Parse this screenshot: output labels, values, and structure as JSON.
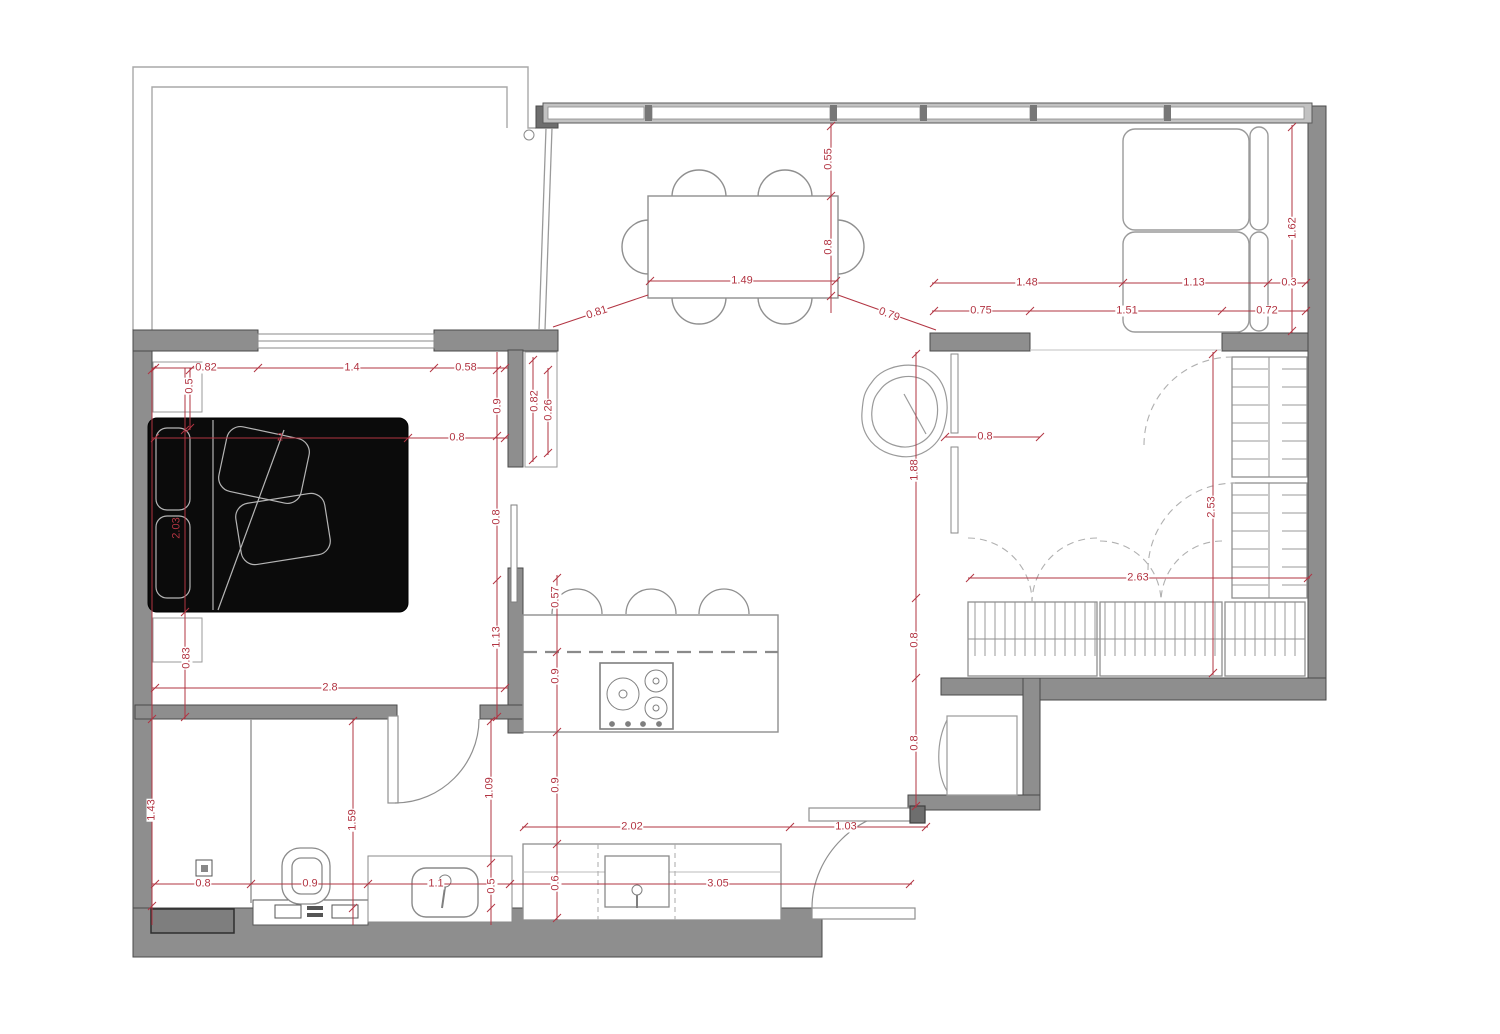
{
  "floorplan": {
    "colors": {
      "dimension_red": "#b23442",
      "wall_gray": "#8e8e8e",
      "wall_dark": "#6e6e6e",
      "bed_black": "#0b0b0b",
      "thin_line_gray": "#9a9a9a"
    },
    "elements": [
      "terrace",
      "living-dining-area",
      "dining-table",
      "dining-chairs",
      "sofa",
      "bedroom",
      "bed",
      "pillows",
      "headboard-cushions",
      "nightstands",
      "wardrobe-cabinet",
      "kitchen-island",
      "cooktop",
      "bar-stools",
      "kitchen-counter",
      "counter-sink",
      "bathroom",
      "shower",
      "shower-drain",
      "toilet",
      "cistern",
      "bathroom-sink",
      "walk-in-closet",
      "shelving-units",
      "hanging-wardrobe",
      "plant",
      "entry-door",
      "bathroom-door",
      "appliance-niche"
    ],
    "dimension_labels": [
      {
        "text": "0.55",
        "x": 829,
        "y": 159,
        "rotate": -90
      },
      {
        "text": "0.8",
        "x": 829,
        "y": 247,
        "rotate": -90
      },
      {
        "text": "1.49",
        "x": 742,
        "y": 281,
        "rotate": 0
      },
      {
        "text": "0.81",
        "x": 597,
        "y": 313,
        "rotate": -18
      },
      {
        "text": "0.79",
        "x": 889,
        "y": 315,
        "rotate": 20
      },
      {
        "text": "1.48",
        "x": 1027,
        "y": 283,
        "rotate": 0
      },
      {
        "text": "1.13",
        "x": 1194,
        "y": 283,
        "rotate": 0
      },
      {
        "text": "0.3",
        "x": 1289,
        "y": 283,
        "rotate": 0
      },
      {
        "text": "0.75",
        "x": 981,
        "y": 311,
        "rotate": 0
      },
      {
        "text": "1.51",
        "x": 1127,
        "y": 311,
        "rotate": 0
      },
      {
        "text": "0.72",
        "x": 1267,
        "y": 311,
        "rotate": 0
      },
      {
        "text": "1.62",
        "x": 1293,
        "y": 228,
        "rotate": -90
      },
      {
        "text": "0.82",
        "x": 206,
        "y": 368,
        "rotate": 0
      },
      {
        "text": "1.4",
        "x": 352,
        "y": 368,
        "rotate": 0
      },
      {
        "text": "0.58",
        "x": 466,
        "y": 368,
        "rotate": 0
      },
      {
        "text": "0.5",
        "x": 190,
        "y": 386,
        "rotate": -90
      },
      {
        "text": "0.9",
        "x": 498,
        "y": 406,
        "rotate": -90
      },
      {
        "text": "2",
        "x": 280,
        "y": 438,
        "rotate": 0,
        "bg": false
      },
      {
        "text": "0.8",
        "x": 457,
        "y": 438,
        "rotate": 0
      },
      {
        "text": "0.82",
        "x": 535,
        "y": 401,
        "rotate": -90
      },
      {
        "text": "0.26",
        "x": 549,
        "y": 410,
        "rotate": -90
      },
      {
        "text": "0.8",
        "x": 497,
        "y": 517,
        "rotate": -90
      },
      {
        "text": "1.13",
        "x": 497,
        "y": 637,
        "rotate": -90
      },
      {
        "text": "2.03",
        "x": 177,
        "y": 528,
        "rotate": -90,
        "bg": false
      },
      {
        "text": "0.83",
        "x": 187,
        "y": 658,
        "rotate": -90
      },
      {
        "text": "2.8",
        "x": 330,
        "y": 688,
        "rotate": 0
      },
      {
        "text": "0.8",
        "x": 985,
        "y": 437,
        "rotate": 0
      },
      {
        "text": "1.88",
        "x": 915,
        "y": 470,
        "rotate": -90
      },
      {
        "text": "0.8",
        "x": 915,
        "y": 640,
        "rotate": -90
      },
      {
        "text": "0.8",
        "x": 915,
        "y": 743,
        "rotate": -90
      },
      {
        "text": "2.63",
        "x": 1138,
        "y": 578,
        "rotate": 0
      },
      {
        "text": "2.53",
        "x": 1212,
        "y": 507,
        "rotate": -90
      },
      {
        "text": "0.57",
        "x": 556,
        "y": 597,
        "rotate": -90
      },
      {
        "text": "0.9",
        "x": 556,
        "y": 676,
        "rotate": -90
      },
      {
        "text": "0.9",
        "x": 556,
        "y": 785,
        "rotate": -90
      },
      {
        "text": "0.6",
        "x": 556,
        "y": 883,
        "rotate": -90
      },
      {
        "text": "2.02",
        "x": 632,
        "y": 827,
        "rotate": 0
      },
      {
        "text": "1.03",
        "x": 846,
        "y": 827,
        "rotate": 0
      },
      {
        "text": "3.05",
        "x": 718,
        "y": 884,
        "rotate": 0
      },
      {
        "text": "1.43",
        "x": 152,
        "y": 810,
        "rotate": -90
      },
      {
        "text": "1.59",
        "x": 353,
        "y": 820,
        "rotate": -90
      },
      {
        "text": "1.09",
        "x": 490,
        "y": 788,
        "rotate": -90
      },
      {
        "text": "0.5",
        "x": 492,
        "y": 886,
        "rotate": -90
      },
      {
        "text": "0.8",
        "x": 203,
        "y": 884,
        "rotate": 0
      },
      {
        "text": "0.9",
        "x": 310,
        "y": 884,
        "rotate": 0
      },
      {
        "text": "1.1",
        "x": 436,
        "y": 884,
        "rotate": 0
      }
    ]
  }
}
